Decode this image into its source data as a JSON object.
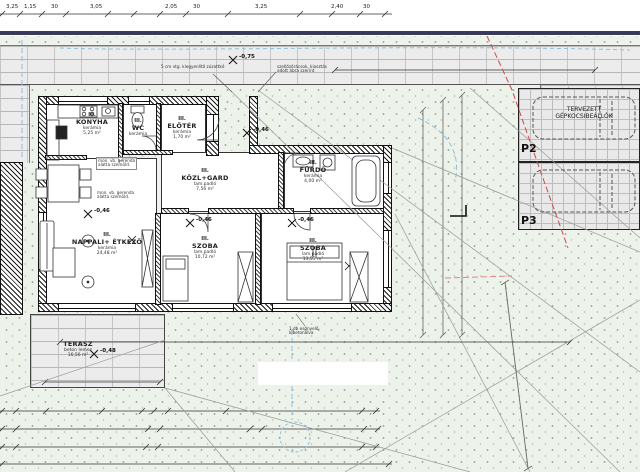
{
  "drawing": {
    "kind": "architectural site / floor plan",
    "unit_style": "hungarian"
  },
  "rooms": [
    {
      "no": "III.",
      "name": "KONYHA",
      "floor": "kerámia",
      "area": "5,25 m²"
    },
    {
      "no": "III.",
      "name": "WC",
      "floor": "kerámia",
      "area": ""
    },
    {
      "no": "III.",
      "name": "ELŐTÉR",
      "floor": "kerámia",
      "area": "1,70 m²"
    },
    {
      "no": "III.",
      "name": "KÖZL+GARD",
      "floor": "lam.padló",
      "area": "7,56 m²"
    },
    {
      "no": "III.",
      "name": "FÜRDŐ",
      "floor": "kerámia",
      "area": "4,00 m²"
    },
    {
      "no": "III.",
      "name": "NAPPALI+ ÉTKEZŐ",
      "floor": "kerámia",
      "area": "24,48 m²"
    },
    {
      "no": "III.",
      "name": "SZOBA",
      "floor": "lam.padló",
      "area": "10,72 m²"
    },
    {
      "no": "III.",
      "name": "SZOBA",
      "floor": "lam.padló",
      "area": "13,53 m²"
    },
    {
      "no": "",
      "name": "TERASZ",
      "floor": "beton lemez",
      "area": "16,56 m²"
    }
  ],
  "dims": {
    "top": [
      "3,25",
      "1,15",
      "30",
      "3,05",
      "2,05",
      "30",
      "3,25",
      "2,40",
      "30"
    ],
    "b1": [
      "25",
      "75",
      "2,35",
      "1,70",
      "25",
      "2,10",
      "5,35",
      "30"
    ],
    "b2": [
      "25",
      "4,80",
      "25",
      "8,25",
      "10",
      "4,19",
      "30"
    ],
    "b3": [
      "25",
      "4,80",
      "25",
      "7,45",
      "30"
    ],
    "b4": [
      "14,05"
    ],
    "sidewalk": "7,70",
    "site": "11,45",
    "r1": "1,18",
    "r2": "30",
    "r3": "2,10",
    "r4": "7,80",
    "terr_w": "560",
    "terr_h": "7,40",
    "i1": "170",
    "i2": "210",
    "i3": "1,55",
    "i4": "95",
    "i5": "1,70",
    "i6": "75",
    "i7": "1,50"
  },
  "levels": [
    "-0,75",
    "-0,46",
    "-0,46",
    "-0,46",
    "-0,46",
    "-0,48"
  ],
  "site": {
    "sidewalk_left": "járda",
    "sidewalk_right": "járda",
    "grass1": "füves terület",
    "grass2": "füves terület",
    "parking_line1": "TERVEZETT",
    "parking_line2": "GÉPKOCSIBEÁLLÓK",
    "stall2": "P2",
    "stall3": "P3",
    "building_line": "BEÉPÍTÉSI HATÁRVONAL",
    "section": "B",
    "ok_dim": "OK 6,0 m"
  },
  "notes": {
    "beam1": "mon. vb. gerenda",
    "beam2": "alatta szemöld.",
    "leveling": "5 cm vtg. kiegyenlítő zúzottkő",
    "vents1": "szellőzőrácsok, kiosztás",
    "vents2": "adott ábra szerint",
    "drain1": "1 db esőnyelő,",
    "drain2": "kibetonálva"
  },
  "colors": {
    "road_edge": "#3a3a5c",
    "boundary": "#cc4a4a",
    "utility": "#8fc0dd",
    "grass_dot": "#9db49b"
  }
}
